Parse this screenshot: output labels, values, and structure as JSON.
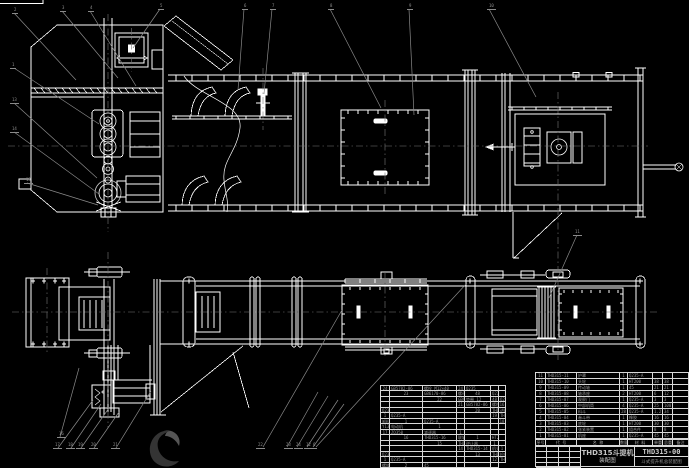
{
  "colors": {
    "line": "#ffffff",
    "leader": "#8a8a8a",
    "table_text": "#969696",
    "centerline": "#777777"
  },
  "title_block": {
    "product_title": "THD315斗提机",
    "drawing_type": "装配图",
    "drawing_number": "THD315-00",
    "subtitle": "斗式提升机总装配图"
  },
  "bom_header": [
    "序号",
    "代  号",
    "名  称",
    "数量",
    "材  料",
    "单重",
    "总重",
    "备注"
  ],
  "bom_right_rows": [
    [
      "11",
      "THD315-11",
      "护罩",
      "1",
      "Q235-A",
      "",
      "",
      ""
    ],
    [
      "10",
      "THD315-10",
      "头轮",
      "1",
      "HT200",
      "38",
      "38",
      ""
    ],
    [
      "9",
      "THD315-09",
      "传动轴",
      "1",
      "45",
      "21",
      "21",
      ""
    ],
    [
      "8",
      "THD315-08",
      "轴承座",
      "2",
      "HT200",
      "6",
      "12",
      ""
    ],
    [
      "7",
      "THD315-07",
      "观察门",
      "1",
      "Q235-A",
      "3",
      "3",
      ""
    ],
    [
      "6",
      "THD315-06",
      "中部机筒",
      "4",
      "Q235-A",
      "25",
      "100",
      ""
    ],
    [
      "5",
      "THD315-05",
      "料斗",
      "28",
      "Q235-A",
      "1.2",
      "34",
      ""
    ],
    [
      "4",
      "THD315-04",
      "畚斗带",
      "1",
      "橡胶",
      "16",
      "16",
      ""
    ],
    [
      "3",
      "THD315-03",
      "底轮",
      "1",
      "HT200",
      "30",
      "30",
      ""
    ],
    [
      "2",
      "THD315-02",
      "张紧装置",
      "1",
      "组合件",
      "8",
      "8",
      ""
    ],
    [
      "1",
      "THD315-01",
      "机座",
      "1",
      "Q235-A",
      "45",
      "45",
      ""
    ]
  ],
  "bom_left_rows": [
    [
      "24",
      "GB5782-86",
      "螺栓 M12×40",
      "24",
      "Q235",
      "",
      "",
      ""
    ],
    [
      "23",
      "GB6170-86",
      "螺母 M12",
      "48",
      "Q235",
      "",
      "",
      ""
    ],
    [
      "22",
      "GB97.1-85",
      "垫圈 12",
      "48",
      "Q235",
      "",
      "",
      ""
    ],
    [
      "21",
      "GB5782-86",
      "螺栓 M10×35",
      "16",
      "Q235",
      "",
      "",
      ""
    ],
    [
      "20",
      "THD315-20",
      "进料口",
      "1",
      "Q235-A",
      "",
      "",
      ""
    ],
    [
      "19",
      "THD315-19",
      "卸料口",
      "1",
      "Q235-A",
      "",
      "",
      ""
    ],
    [
      "18",
      "Y132M-4",
      "电动机",
      "1",
      "",
      "",
      "",
      ""
    ],
    [
      "17",
      "ZQ350",
      "减速器",
      "1",
      "",
      "",
      "",
      ""
    ],
    [
      "16",
      "THD315-16",
      "联轴器",
      "1",
      "HT200",
      "",
      "",
      ""
    ],
    [
      "15",
      "THD315-15",
      "逆止器",
      "1",
      "",
      "",
      "",
      ""
    ],
    [
      "14",
      "THD315-14",
      "机头罩",
      "1",
      "Q235-A",
      "",
      "",
      ""
    ],
    [
      "13",
      "THD315-13",
      "检修门",
      "1",
      "Q235-A",
      "",
      "",
      ""
    ],
    [
      "12",
      "THD315-12",
      "螺旋拉紧装置",
      "2",
      "45",
      "",
      "",
      ""
    ]
  ],
  "callouts": [
    {
      "x": 12,
      "y": 8,
      "n": "2"
    },
    {
      "x": 60,
      "y": 6,
      "n": "3"
    },
    {
      "x": 88,
      "y": 6,
      "n": "4"
    },
    {
      "x": 158,
      "y": 4,
      "n": "5"
    },
    {
      "x": 242,
      "y": 4,
      "n": "6"
    },
    {
      "x": 270,
      "y": 4,
      "n": "7"
    },
    {
      "x": 328,
      "y": 4,
      "n": "8"
    },
    {
      "x": 407,
      "y": 4,
      "n": "9"
    },
    {
      "x": 487,
      "y": 4,
      "n": "10"
    },
    {
      "x": 10,
      "y": 63,
      "n": "1"
    },
    {
      "x": 10,
      "y": 98,
      "n": "13"
    },
    {
      "x": 10,
      "y": 127,
      "n": "14"
    },
    {
      "x": 24,
      "y": 178,
      "n": "15"
    },
    {
      "x": 573,
      "y": 230,
      "n": "11"
    },
    {
      "x": 57,
      "y": 432,
      "n": "16"
    },
    {
      "x": 53,
      "y": 443,
      "n": "17"
    },
    {
      "x": 66,
      "y": 443,
      "n": "18"
    },
    {
      "x": 76,
      "y": 443,
      "n": "19"
    },
    {
      "x": 89,
      "y": 443,
      "n": "20"
    },
    {
      "x": 111,
      "y": 443,
      "n": "21"
    },
    {
      "x": 256,
      "y": 443,
      "n": "22"
    },
    {
      "x": 284,
      "y": 443,
      "n": "23"
    },
    {
      "x": 294,
      "y": 443,
      "n": "24"
    },
    {
      "x": 304,
      "y": 443,
      "n": "12"
    },
    {
      "x": 311,
      "y": 443,
      "n": "6"
    }
  ]
}
